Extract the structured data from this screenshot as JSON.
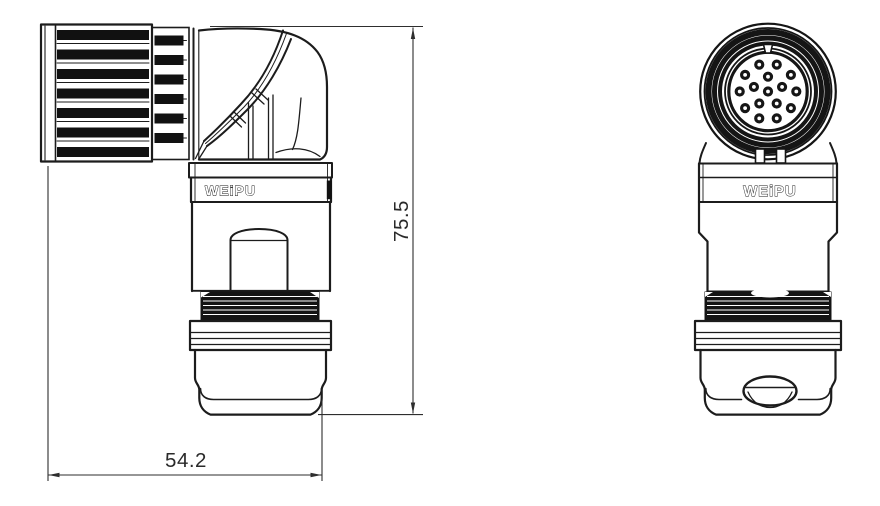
{
  "drawing": {
    "brand_label": "WEiPU",
    "dimensions": {
      "height": {
        "value": "75.5"
      },
      "width": {
        "value": "54.2"
      }
    },
    "front_view": {
      "pin_count": 16,
      "face_center": {
        "x": 768,
        "y": 91.5
      },
      "pin_outer_radius": 3.5,
      "pin_layout": {
        "center": {
          "count": 1,
          "radius": 0,
          "phase_deg": 0
        },
        "inner": {
          "count": 5,
          "radius": 14.8,
          "phase_deg": 0
        },
        "outer": {
          "count": 10,
          "radius": 28.3,
          "phase_deg": 18
        }
      }
    }
  }
}
